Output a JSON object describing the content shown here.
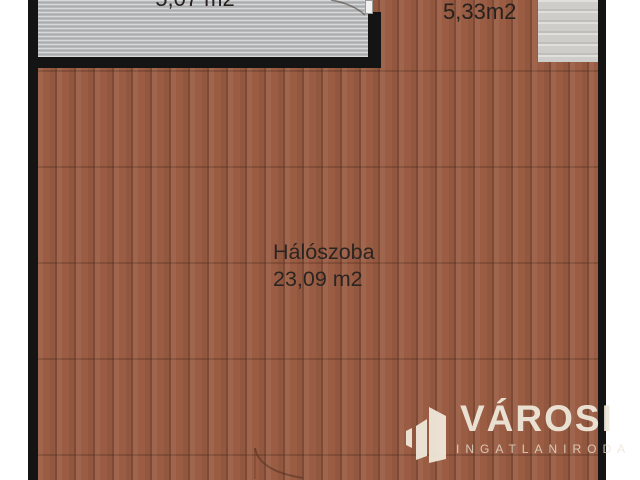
{
  "floorplan": {
    "rooms": {
      "upper_left": {
        "area": "5,07 m2"
      },
      "upper_right": {
        "area": "5,33m2"
      },
      "bedroom": {
        "name": "Hálószoba",
        "area": "23,09 m2"
      }
    },
    "colors": {
      "wood_floor": "#9a5c42",
      "tile_floor": "#b8babc",
      "stairs": "#cfcecb",
      "wall": "#141414",
      "label_text": "#26211e",
      "watermark": "#efe8da"
    }
  },
  "watermark": {
    "brand": "VÁROSI",
    "subtitle": "INGATLANIRODA"
  }
}
